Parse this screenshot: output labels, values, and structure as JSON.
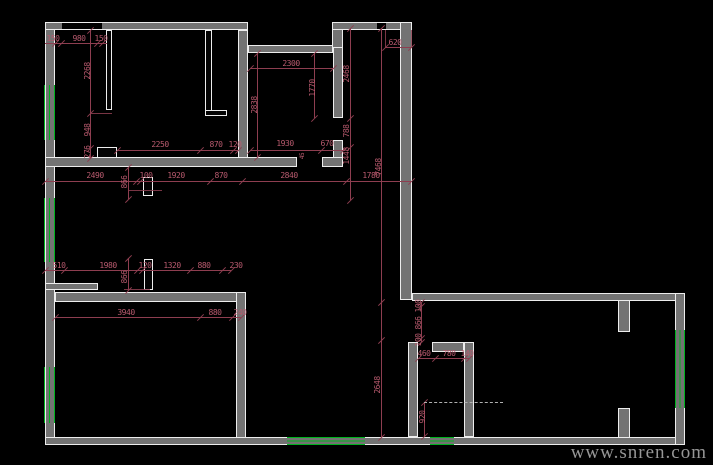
{
  "canvas": {
    "width": 713,
    "height": 465,
    "background": "#000000"
  },
  "palette": {
    "wall_fill": "#737373",
    "wall_line": "#ededed",
    "dimension_line": "#8e3e50",
    "dimension_text": "#b85a6e",
    "window_green": "#00b41e",
    "dashed_line": "#b0b0b0",
    "watermark_color": "#969696"
  },
  "watermark": {
    "text": "www.snren.com"
  },
  "drawing": {
    "type": "cad-floor-plan",
    "elements": [
      {
        "t": "wall",
        "x": 45,
        "y": 22,
        "w": 10,
        "h": 423
      },
      {
        "t": "wall",
        "x": 45,
        "y": 22,
        "w": 203,
        "h": 8
      },
      {
        "t": "wall",
        "x": 238,
        "y": 30,
        "w": 10,
        "h": 132
      },
      {
        "t": "wall",
        "x": 248,
        "y": 45,
        "w": 85,
        "h": 8
      },
      {
        "t": "wall",
        "x": 332,
        "y": 22,
        "w": 11,
        "h": 31
      },
      {
        "t": "wall",
        "x": 332,
        "y": 22,
        "w": 80,
        "h": 8
      },
      {
        "t": "wall",
        "x": 400,
        "y": 22,
        "w": 12,
        "h": 278
      },
      {
        "t": "wall",
        "x": 333,
        "y": 47,
        "w": 10,
        "h": 71
      },
      {
        "t": "wall",
        "x": 333,
        "y": 140,
        "w": 10,
        "h": 27
      },
      {
        "t": "wall",
        "x": 45,
        "y": 157,
        "w": 252,
        "h": 10
      },
      {
        "t": "wall",
        "x": 322,
        "y": 157,
        "w": 21,
        "h": 10
      },
      {
        "t": "wall",
        "x": 45,
        "y": 283,
        "w": 53,
        "h": 7
      },
      {
        "t": "wall",
        "x": 55,
        "y": 292,
        "w": 183,
        "h": 10
      },
      {
        "t": "wall",
        "x": 236,
        "y": 292,
        "w": 10,
        "h": 153
      },
      {
        "t": "wall",
        "x": 45,
        "y": 437,
        "w": 640,
        "h": 8
      },
      {
        "t": "wall",
        "x": 412,
        "y": 293,
        "w": 273,
        "h": 8
      },
      {
        "t": "wall",
        "x": 675,
        "y": 293,
        "w": 10,
        "h": 152
      },
      {
        "t": "wall",
        "x": 618,
        "y": 300,
        "w": 12,
        "h": 32
      },
      {
        "t": "wall",
        "x": 618,
        "y": 408,
        "w": 12,
        "h": 30
      },
      {
        "t": "wall",
        "x": 408,
        "y": 342,
        "w": 10,
        "h": 95
      },
      {
        "t": "wall",
        "x": 432,
        "y": 342,
        "w": 32,
        "h": 10
      },
      {
        "t": "wall",
        "x": 464,
        "y": 342,
        "w": 10,
        "h": 95
      },
      {
        "t": "window",
        "o": "v",
        "x": 44,
        "y": 85,
        "w": 11,
        "h": 55
      },
      {
        "t": "window",
        "o": "v",
        "x": 44,
        "y": 198,
        "w": 11,
        "h": 64
      },
      {
        "t": "window",
        "o": "v",
        "x": 44,
        "y": 367,
        "w": 11,
        "h": 56
      },
      {
        "t": "window",
        "o": "h",
        "x": 287,
        "y": 437,
        "w": 78,
        "h": 8
      },
      {
        "t": "window",
        "o": "h",
        "x": 430,
        "y": 437,
        "w": 24,
        "h": 8
      },
      {
        "t": "window",
        "o": "v",
        "x": 675,
        "y": 330,
        "w": 10,
        "h": 78
      },
      {
        "t": "jamb",
        "x": 106,
        "y": 30,
        "w": 6,
        "h": 80
      },
      {
        "t": "jamb",
        "x": 205,
        "y": 30,
        "w": 7,
        "h": 83
      },
      {
        "t": "jamb",
        "x": 205,
        "y": 110,
        "w": 22,
        "h": 6
      },
      {
        "t": "jamb",
        "x": 97,
        "y": 147,
        "w": 20,
        "h": 11
      },
      {
        "t": "jamb",
        "x": 143,
        "y": 177,
        "w": 10,
        "h": 19
      },
      {
        "t": "jamb",
        "x": 144,
        "y": 259,
        "w": 9,
        "h": 31
      },
      {
        "t": "opening",
        "o": "h",
        "x": 62,
        "y": 22,
        "w": 40,
        "h": 8
      },
      {
        "t": "opening",
        "o": "h",
        "x": 377,
        "y": 22,
        "w": 9,
        "h": 8
      },
      {
        "t": "dim",
        "d": "h",
        "x": 45,
        "y": 43,
        "len": 62,
        "ticks": [
          55,
          61,
          97,
          102
        ]
      },
      {
        "t": "dim",
        "d": "h",
        "x": 385,
        "y": 47,
        "len": 26,
        "ticks": [
          385,
          411
        ]
      },
      {
        "t": "dim",
        "d": "h",
        "x": 250,
        "y": 68,
        "len": 83,
        "ticks": [
          250,
          333
        ]
      },
      {
        "t": "dim",
        "d": "h",
        "x": 117,
        "y": 150,
        "len": 121,
        "ticks": [
          117,
          200,
          233,
          238
        ]
      },
      {
        "t": "dim",
        "d": "h",
        "x": 250,
        "y": 150,
        "len": 93,
        "ticks": [
          250,
          321,
          343
        ]
      },
      {
        "t": "dim",
        "d": "h",
        "x": 45,
        "y": 181,
        "len": 366,
        "ticks": [
          45,
          136,
          140,
          210,
          242,
          346,
          411
        ]
      },
      {
        "t": "dim",
        "d": "h",
        "x": 45,
        "y": 270,
        "len": 186,
        "ticks": [
          45,
          64,
          137,
          142,
          190,
          222,
          231
        ]
      },
      {
        "t": "dim",
        "d": "h",
        "x": 55,
        "y": 317,
        "len": 186,
        "ticks": [
          55,
          200,
          232,
          241
        ]
      },
      {
        "t": "dim",
        "d": "h",
        "x": 418,
        "y": 358,
        "len": 51,
        "ticks": [
          418,
          435,
          464,
          469
        ]
      },
      {
        "t": "dim",
        "d": "v",
        "x": 90,
        "y": 30,
        "len": 128,
        "ticks": [
          30,
          113,
          148,
          158
        ]
      },
      {
        "t": "dim",
        "d": "v",
        "x": 257,
        "y": 53,
        "len": 104,
        "ticks": [
          53,
          157
        ]
      },
      {
        "t": "dim",
        "d": "v",
        "x": 314,
        "y": 53,
        "len": 65,
        "ticks": [
          53,
          118
        ]
      },
      {
        "t": "dim",
        "d": "v",
        "x": 350,
        "y": 28,
        "len": 172,
        "ticks": [
          28,
          118,
          147,
          200
        ]
      },
      {
        "t": "dim",
        "d": "v",
        "x": 381,
        "y": 28,
        "len": 409,
        "ticks": [
          28,
          302,
          340,
          437
        ]
      },
      {
        "t": "dim",
        "d": "v",
        "x": 421,
        "y": 302,
        "len": 40,
        "ticks": [
          302,
          306,
          338,
          342
        ]
      },
      {
        "t": "dim",
        "d": "v",
        "x": 424,
        "y": 402,
        "len": 34,
        "ticks": [
          402,
          436
        ]
      },
      {
        "t": "dim",
        "d": "v",
        "x": 128,
        "y": 167,
        "len": 32,
        "ticks": [
          167,
          199
        ]
      },
      {
        "t": "dim",
        "d": "v",
        "x": 128,
        "y": 258,
        "len": 32,
        "ticks": [
          258,
          290
        ]
      },
      {
        "t": "ext",
        "d": "v",
        "x": 385,
        "y": 30,
        "len": 18
      },
      {
        "t": "ext",
        "d": "v",
        "x": 411,
        "y": 30,
        "len": 18
      },
      {
        "t": "ext",
        "d": "h",
        "x": 90,
        "y": 113,
        "len": 22
      },
      {
        "t": "ext",
        "d": "h",
        "x": 128,
        "y": 190,
        "len": 34
      },
      {
        "t": "ext",
        "d": "h",
        "x": 124,
        "y": 289,
        "len": 26
      },
      {
        "t": "dashed",
        "x": 424,
        "y": 402,
        "len": 79
      },
      {
        "t": "label",
        "text": "150",
        "x": 53,
        "y": 39
      },
      {
        "t": "label",
        "text": "980",
        "x": 79,
        "y": 39
      },
      {
        "t": "label",
        "text": "150",
        "x": 101,
        "y": 39
      },
      {
        "t": "label",
        "text": "2268",
        "x": 88,
        "y": 71,
        "rot": 1
      },
      {
        "t": "label",
        "text": "948",
        "x": 88,
        "y": 130,
        "rot": 1
      },
      {
        "t": "label",
        "text": "276",
        "x": 88,
        "y": 152,
        "rot": 1
      },
      {
        "t": "label",
        "text": "2250",
        "x": 160,
        "y": 145
      },
      {
        "t": "label",
        "text": "870",
        "x": 216,
        "y": 145
      },
      {
        "t": "label",
        "text": "120",
        "x": 235,
        "y": 145
      },
      {
        "t": "label",
        "text": "2490",
        "x": 95,
        "y": 176
      },
      {
        "t": "label",
        "text": "100",
        "x": 146,
        "y": 176
      },
      {
        "t": "label",
        "text": "1920",
        "x": 176,
        "y": 176
      },
      {
        "t": "label",
        "text": "870",
        "x": 221,
        "y": 176
      },
      {
        "t": "label",
        "text": "2840",
        "x": 289,
        "y": 176
      },
      {
        "t": "label",
        "text": "1780",
        "x": 371,
        "y": 176
      },
      {
        "t": "label",
        "text": "866",
        "x": 125,
        "y": 182,
        "rot": 1
      },
      {
        "t": "label",
        "text": "866",
        "x": 125,
        "y": 277,
        "rot": 1
      },
      {
        "t": "label",
        "text": "2300",
        "x": 291,
        "y": 64
      },
      {
        "t": "label",
        "text": "1770",
        "x": 313,
        "y": 88,
        "rot": 1
      },
      {
        "t": "label",
        "text": "2838",
        "x": 255,
        "y": 105,
        "rot": 1
      },
      {
        "t": "label",
        "text": "1930",
        "x": 285,
        "y": 144
      },
      {
        "t": "label",
        "text": "670",
        "x": 327,
        "y": 144
      },
      {
        "t": "label",
        "text": "45",
        "x": 303,
        "y": 156,
        "rot": 1,
        "small": 1
      },
      {
        "t": "label",
        "text": "2468",
        "x": 347,
        "y": 74,
        "rot": 1
      },
      {
        "t": "label",
        "text": "788",
        "x": 347,
        "y": 131,
        "rot": 1
      },
      {
        "t": "label",
        "text": "1448",
        "x": 347,
        "y": 156,
        "rot": 1
      },
      {
        "t": "label",
        "text": "620",
        "x": 395,
        "y": 43
      },
      {
        "t": "label",
        "text": "7468",
        "x": 379,
        "y": 167,
        "rot": 1
      },
      {
        "t": "label",
        "text": "2648",
        "x": 378,
        "y": 385,
        "rot": 1
      },
      {
        "t": "label",
        "text": "100",
        "x": 419,
        "y": 306,
        "rot": 1
      },
      {
        "t": "label",
        "text": "866",
        "x": 419,
        "y": 323,
        "rot": 1
      },
      {
        "t": "label",
        "text": "100",
        "x": 419,
        "y": 340,
        "rot": 1
      },
      {
        "t": "label",
        "text": "460",
        "x": 424,
        "y": 354
      },
      {
        "t": "label",
        "text": "780",
        "x": 449,
        "y": 354
      },
      {
        "t": "label",
        "text": "140",
        "x": 467,
        "y": 354
      },
      {
        "t": "label",
        "text": "920",
        "x": 423,
        "y": 417,
        "rot": 1
      },
      {
        "t": "label",
        "text": "510",
        "x": 59,
        "y": 266
      },
      {
        "t": "label",
        "text": "1980",
        "x": 108,
        "y": 266
      },
      {
        "t": "label",
        "text": "120",
        "x": 145,
        "y": 266
      },
      {
        "t": "label",
        "text": "1320",
        "x": 172,
        "y": 266
      },
      {
        "t": "label",
        "text": "880",
        "x": 204,
        "y": 266
      },
      {
        "t": "label",
        "text": "230",
        "x": 236,
        "y": 266
      },
      {
        "t": "label",
        "text": "3940",
        "x": 126,
        "y": 313
      },
      {
        "t": "label",
        "text": "880",
        "x": 215,
        "y": 313
      },
      {
        "t": "label",
        "text": "240",
        "x": 240,
        "y": 313
      }
    ]
  }
}
